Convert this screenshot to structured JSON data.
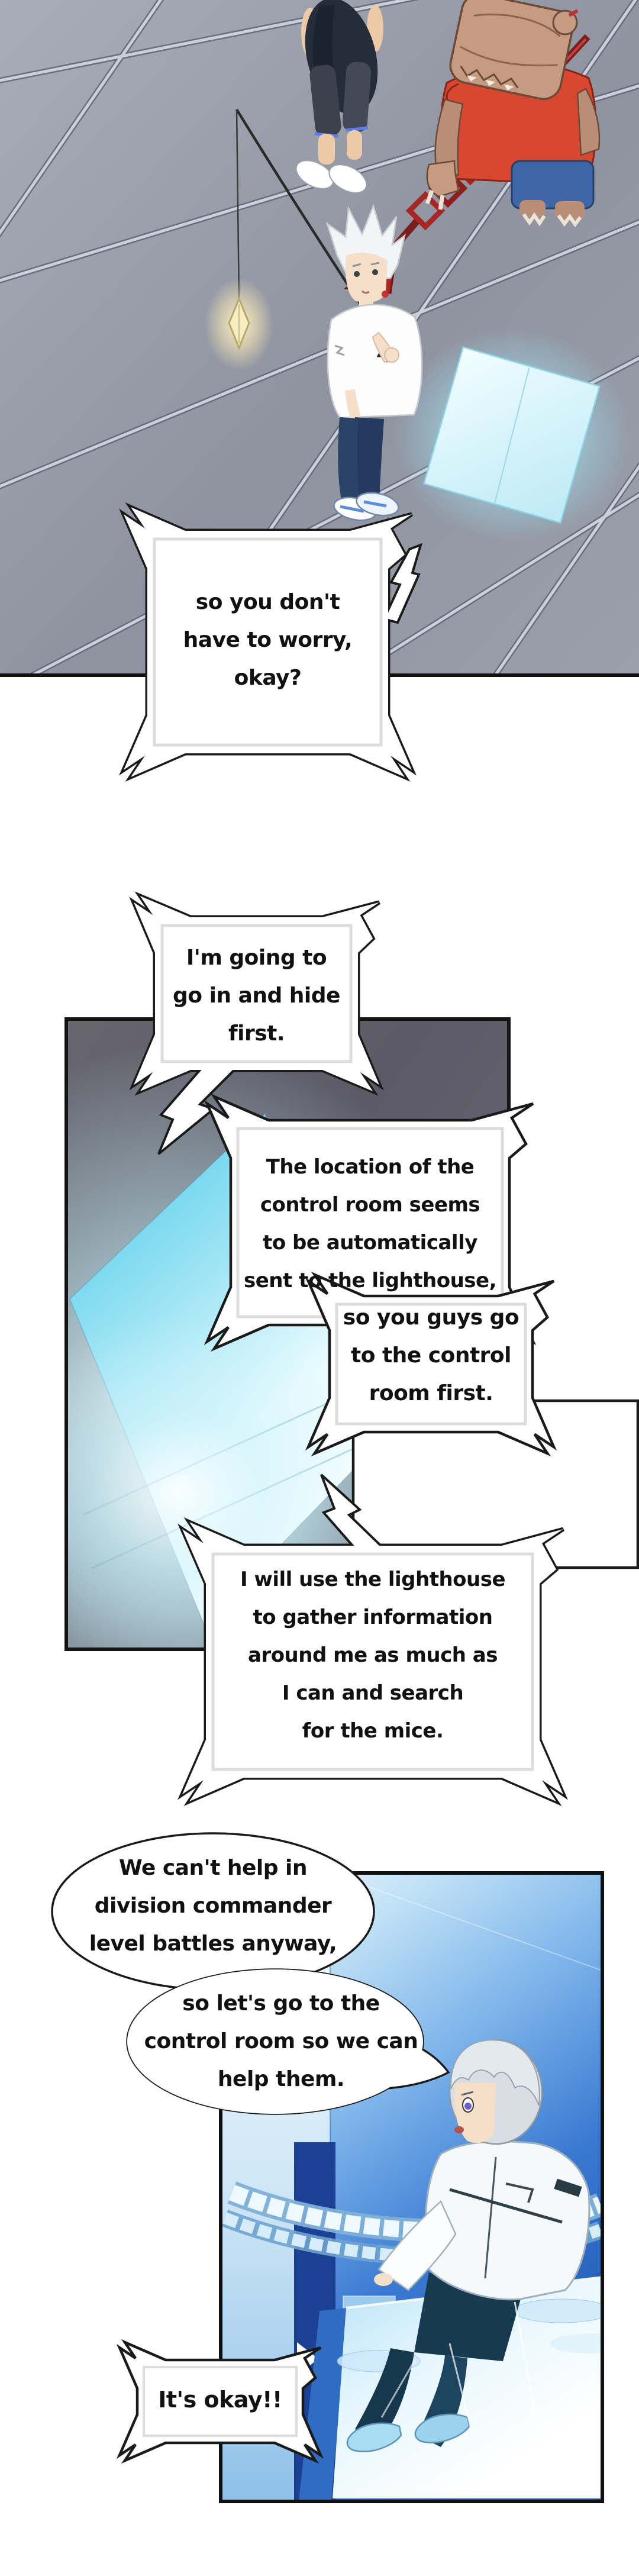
{
  "bubbles": {
    "b1": "so you don't\nhave to worry,\nokay?",
    "b2": "I'm going to\ngo in and hide\nfirst.",
    "b3a": "The location of the\ncontrol room seems\nto be automatically\nsent to the lighthouse,",
    "b3b": "so you guys go\nto the control\nroom first.",
    "b4": "I will use the lighthouse\nto gather information\naround me as much as\nI can and search\nfor the mice.",
    "b5a": "We can't help in\ndivision commander\nlevel battles anyway,",
    "b5b": "so let's go to the\ncontrol room so we can\nhelp them.",
    "b6": "It's okay!!"
  },
  "colors": {
    "floor_gray": "#989dab",
    "stripe_light": "#ccd0d9",
    "dark_panel": "#5e5d69",
    "glow_cyan": "#8fe0f5",
    "control_room_blue": "#2e6fc9",
    "navy_band": "#1c4094",
    "spear_red": "#a62c2c",
    "shirt_red": "#d8472f",
    "bag_tan": "#c79a82",
    "bubble_border": "#1a1a1a"
  }
}
